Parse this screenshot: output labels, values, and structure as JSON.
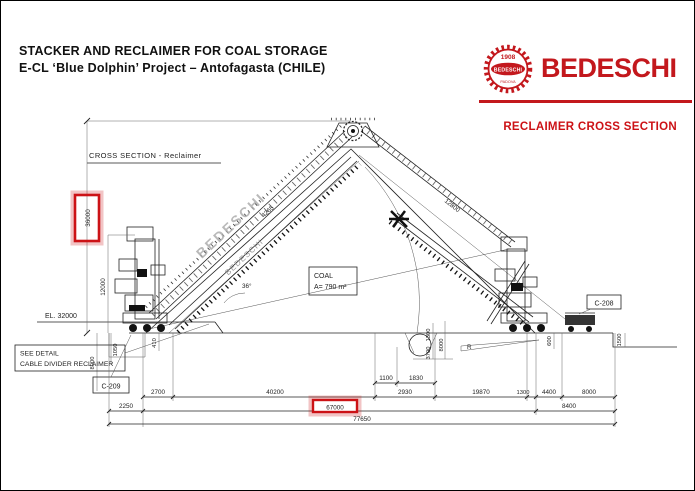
{
  "header": {
    "title_line1": "STACKER AND RECLAIMER FOR COAL STORAGE",
    "title_line2": "E-CL ‘Blue Dolphin’ Project – Antofagasta (CHILE)",
    "section_label": "RECLAIMER CROSS SECTION",
    "brand_color": "#c3181d",
    "logo": {
      "year": "1908",
      "oval_text": "BEDESCHI",
      "city": "PADOVA",
      "wordmark": "BEDESCHI"
    }
  },
  "drawing": {
    "caption": "CROSS SECTION - Reclaimer",
    "elevation": "EL. 32000",
    "see_detail_line1": "SEE DETAIL",
    "see_detail_line2": "CABLE DIVIDER RECLAIMER",
    "ref_c209": "C-209",
    "ref_c208": "C-208",
    "coal_box": {
      "line1": "COAL",
      "line2": "A= 790 m²"
    },
    "boom_text_upper": "BEDESCHI",
    "boom_text_lower": "BEDESCHI",
    "boom_dim_left": "4265",
    "boom_dim_right": "12800",
    "angle": "36°",
    "slope_mark": "R",
    "highlight_color": "#cc1216",
    "dims_vertical": {
      "total_height": "36000",
      "machine_height": "12000",
      "pit_depth": "8000",
      "d1050": "1050",
      "d410": "410",
      "d1300": "1300",
      "d3700": "3700",
      "mid_8000": "8000",
      "d600": "600",
      "d1500": "1500"
    },
    "dims_horizontal": {
      "d2700": "2700",
      "d40200": "40200",
      "d1100": "1100",
      "d1830": "1830",
      "d2930": "2930",
      "d19870": "19870",
      "d1300": "1300",
      "d4400": "4400",
      "d8000": "8000",
      "d2250": "2250",
      "d67000": "67000",
      "d8400": "8400",
      "d77650": "77650"
    }
  }
}
